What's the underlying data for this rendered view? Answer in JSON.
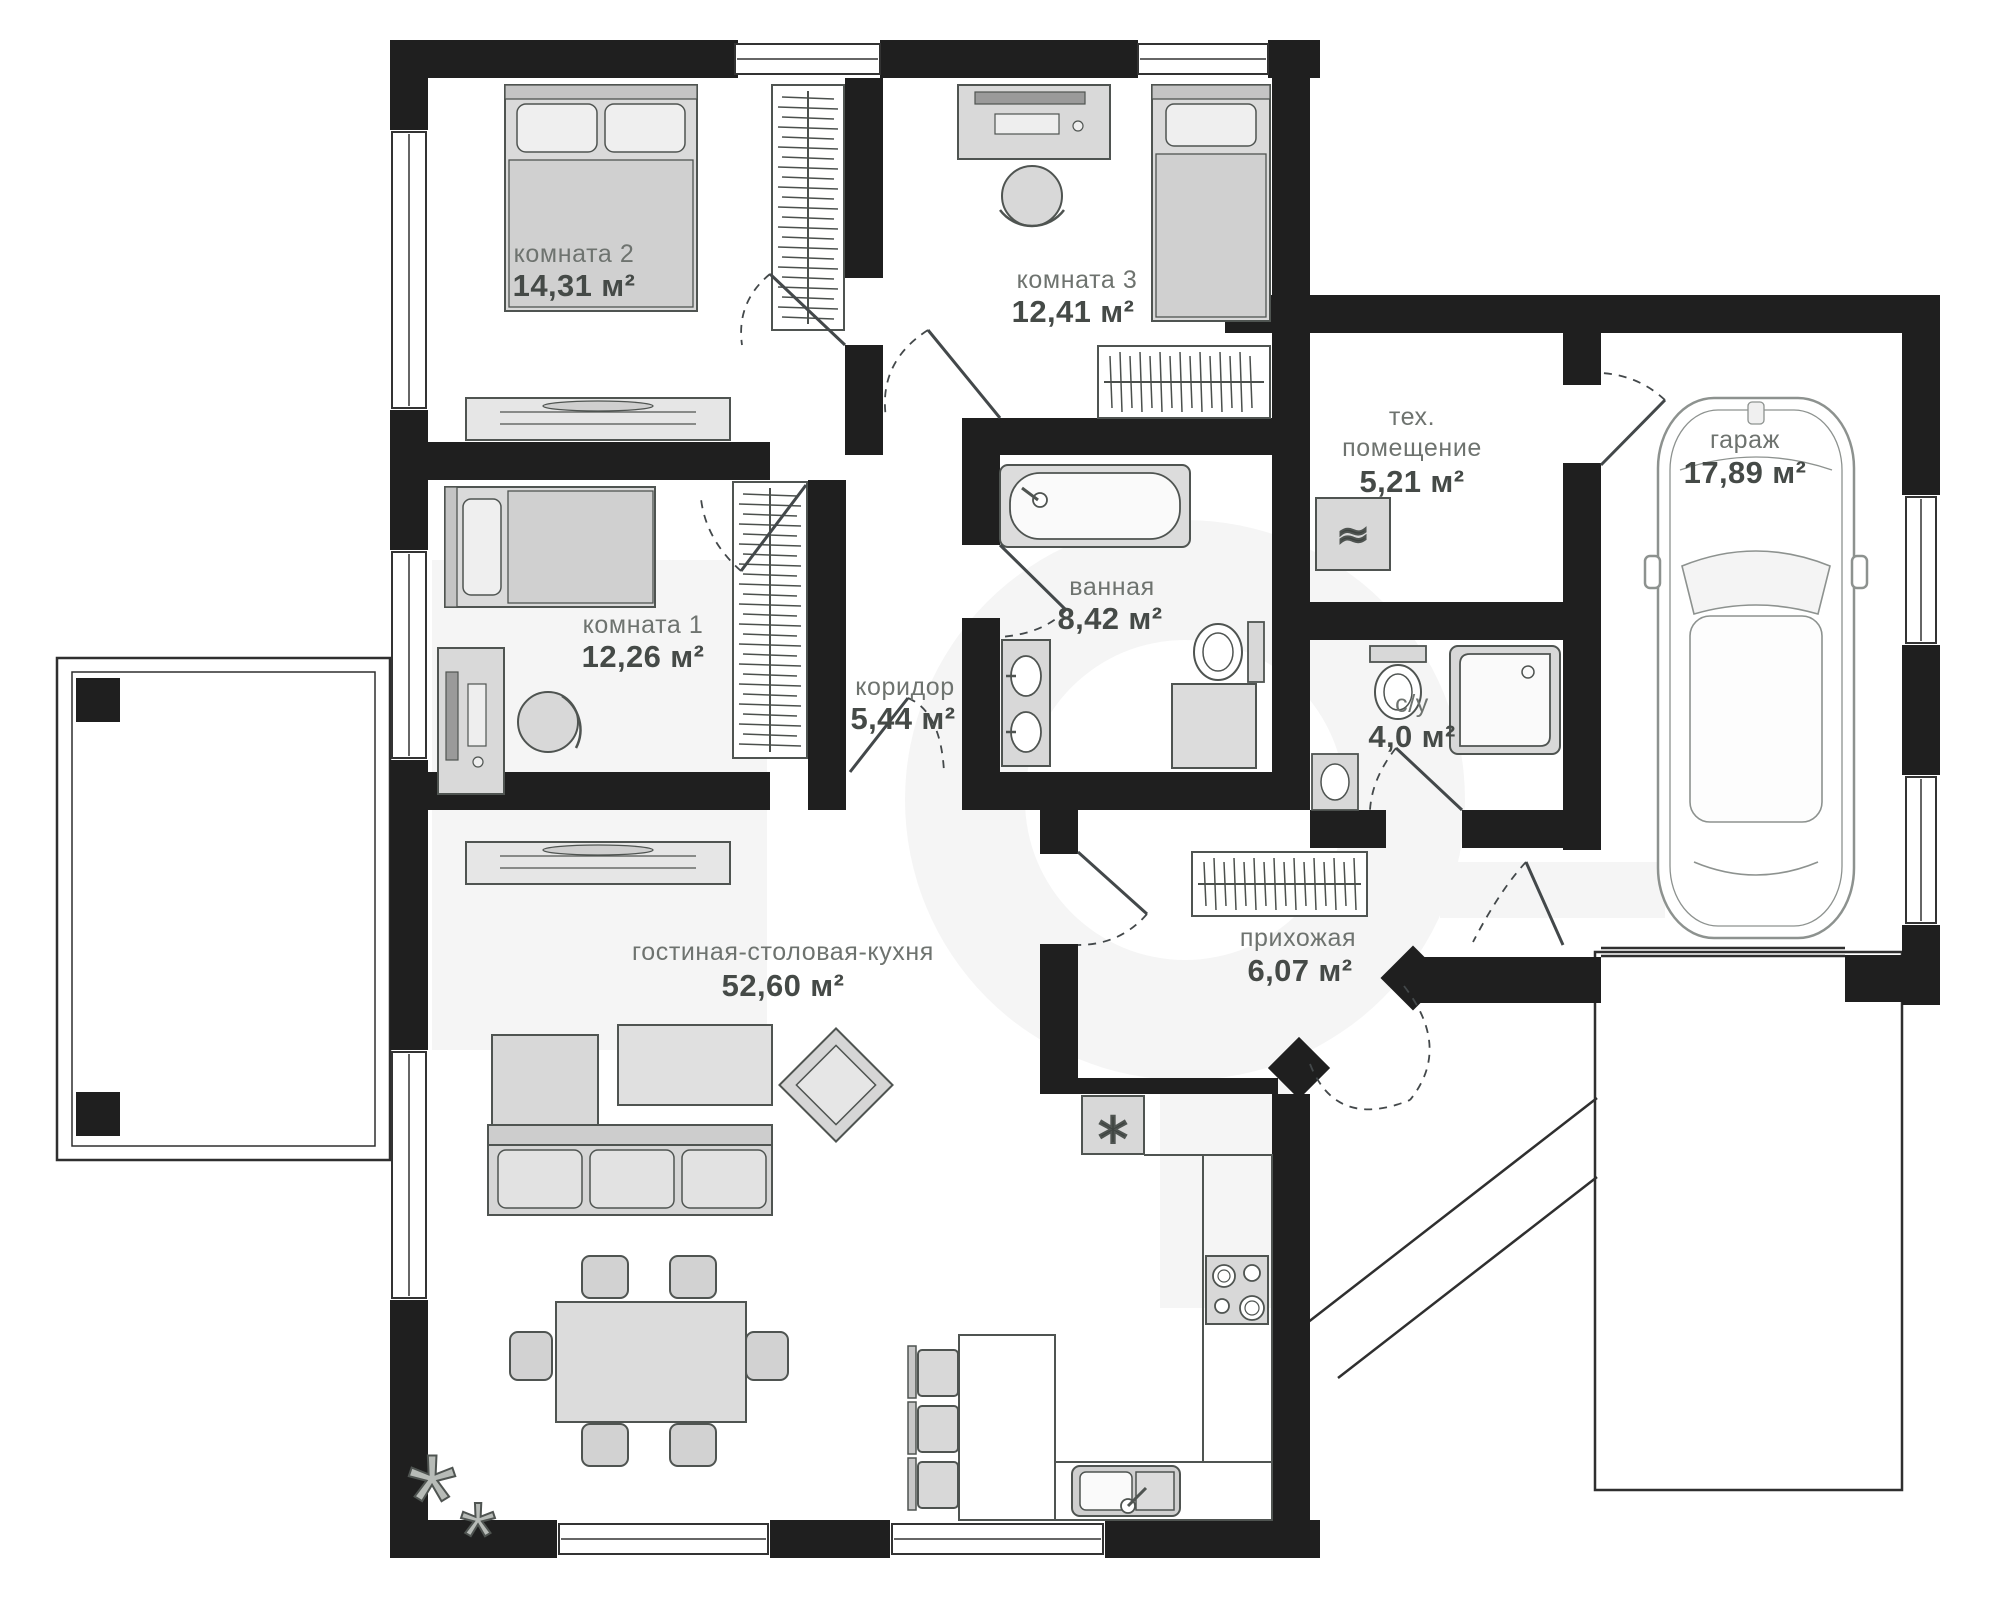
{
  "plan": {
    "type": "floor_plan",
    "language": "ru",
    "rooms": [
      {
        "id": "room2",
        "name": "комната 2",
        "area": "14,31 м²"
      },
      {
        "id": "room3",
        "name": "комната 3",
        "area": "12,41 м²"
      },
      {
        "id": "room1",
        "name": "комната 1",
        "area": "12,26 м²"
      },
      {
        "id": "corridor",
        "name": "коридор",
        "area": "5,44 м²"
      },
      {
        "id": "bathroom",
        "name": "ванная",
        "area": "8,42 м²"
      },
      {
        "id": "tech",
        "name": "тех. помещение",
        "area": "5,21 м²",
        "lines": [
          "тех.",
          "помещение"
        ]
      },
      {
        "id": "wc",
        "name": "с/у",
        "area": "4,0 м²"
      },
      {
        "id": "garage",
        "name": "гараж",
        "area": "17,89 м²"
      },
      {
        "id": "hall",
        "name": "прихожая",
        "area": "6,07 м²"
      },
      {
        "id": "living",
        "name": "гостиная-столовая-кухня",
        "area": "52,60 м²"
      }
    ],
    "icons": {
      "fridge": "*",
      "boiler": "≈",
      "plant_big": "*",
      "plant_small": "*"
    },
    "colors": {
      "wall": "#1f1f1f",
      "furniture_fill": "#d8d8d8",
      "furniture_stroke": "#4f5451",
      "label_name": "#6e736f",
      "label_area": "#454a47",
      "watermark": "#f5f5f5"
    }
  }
}
